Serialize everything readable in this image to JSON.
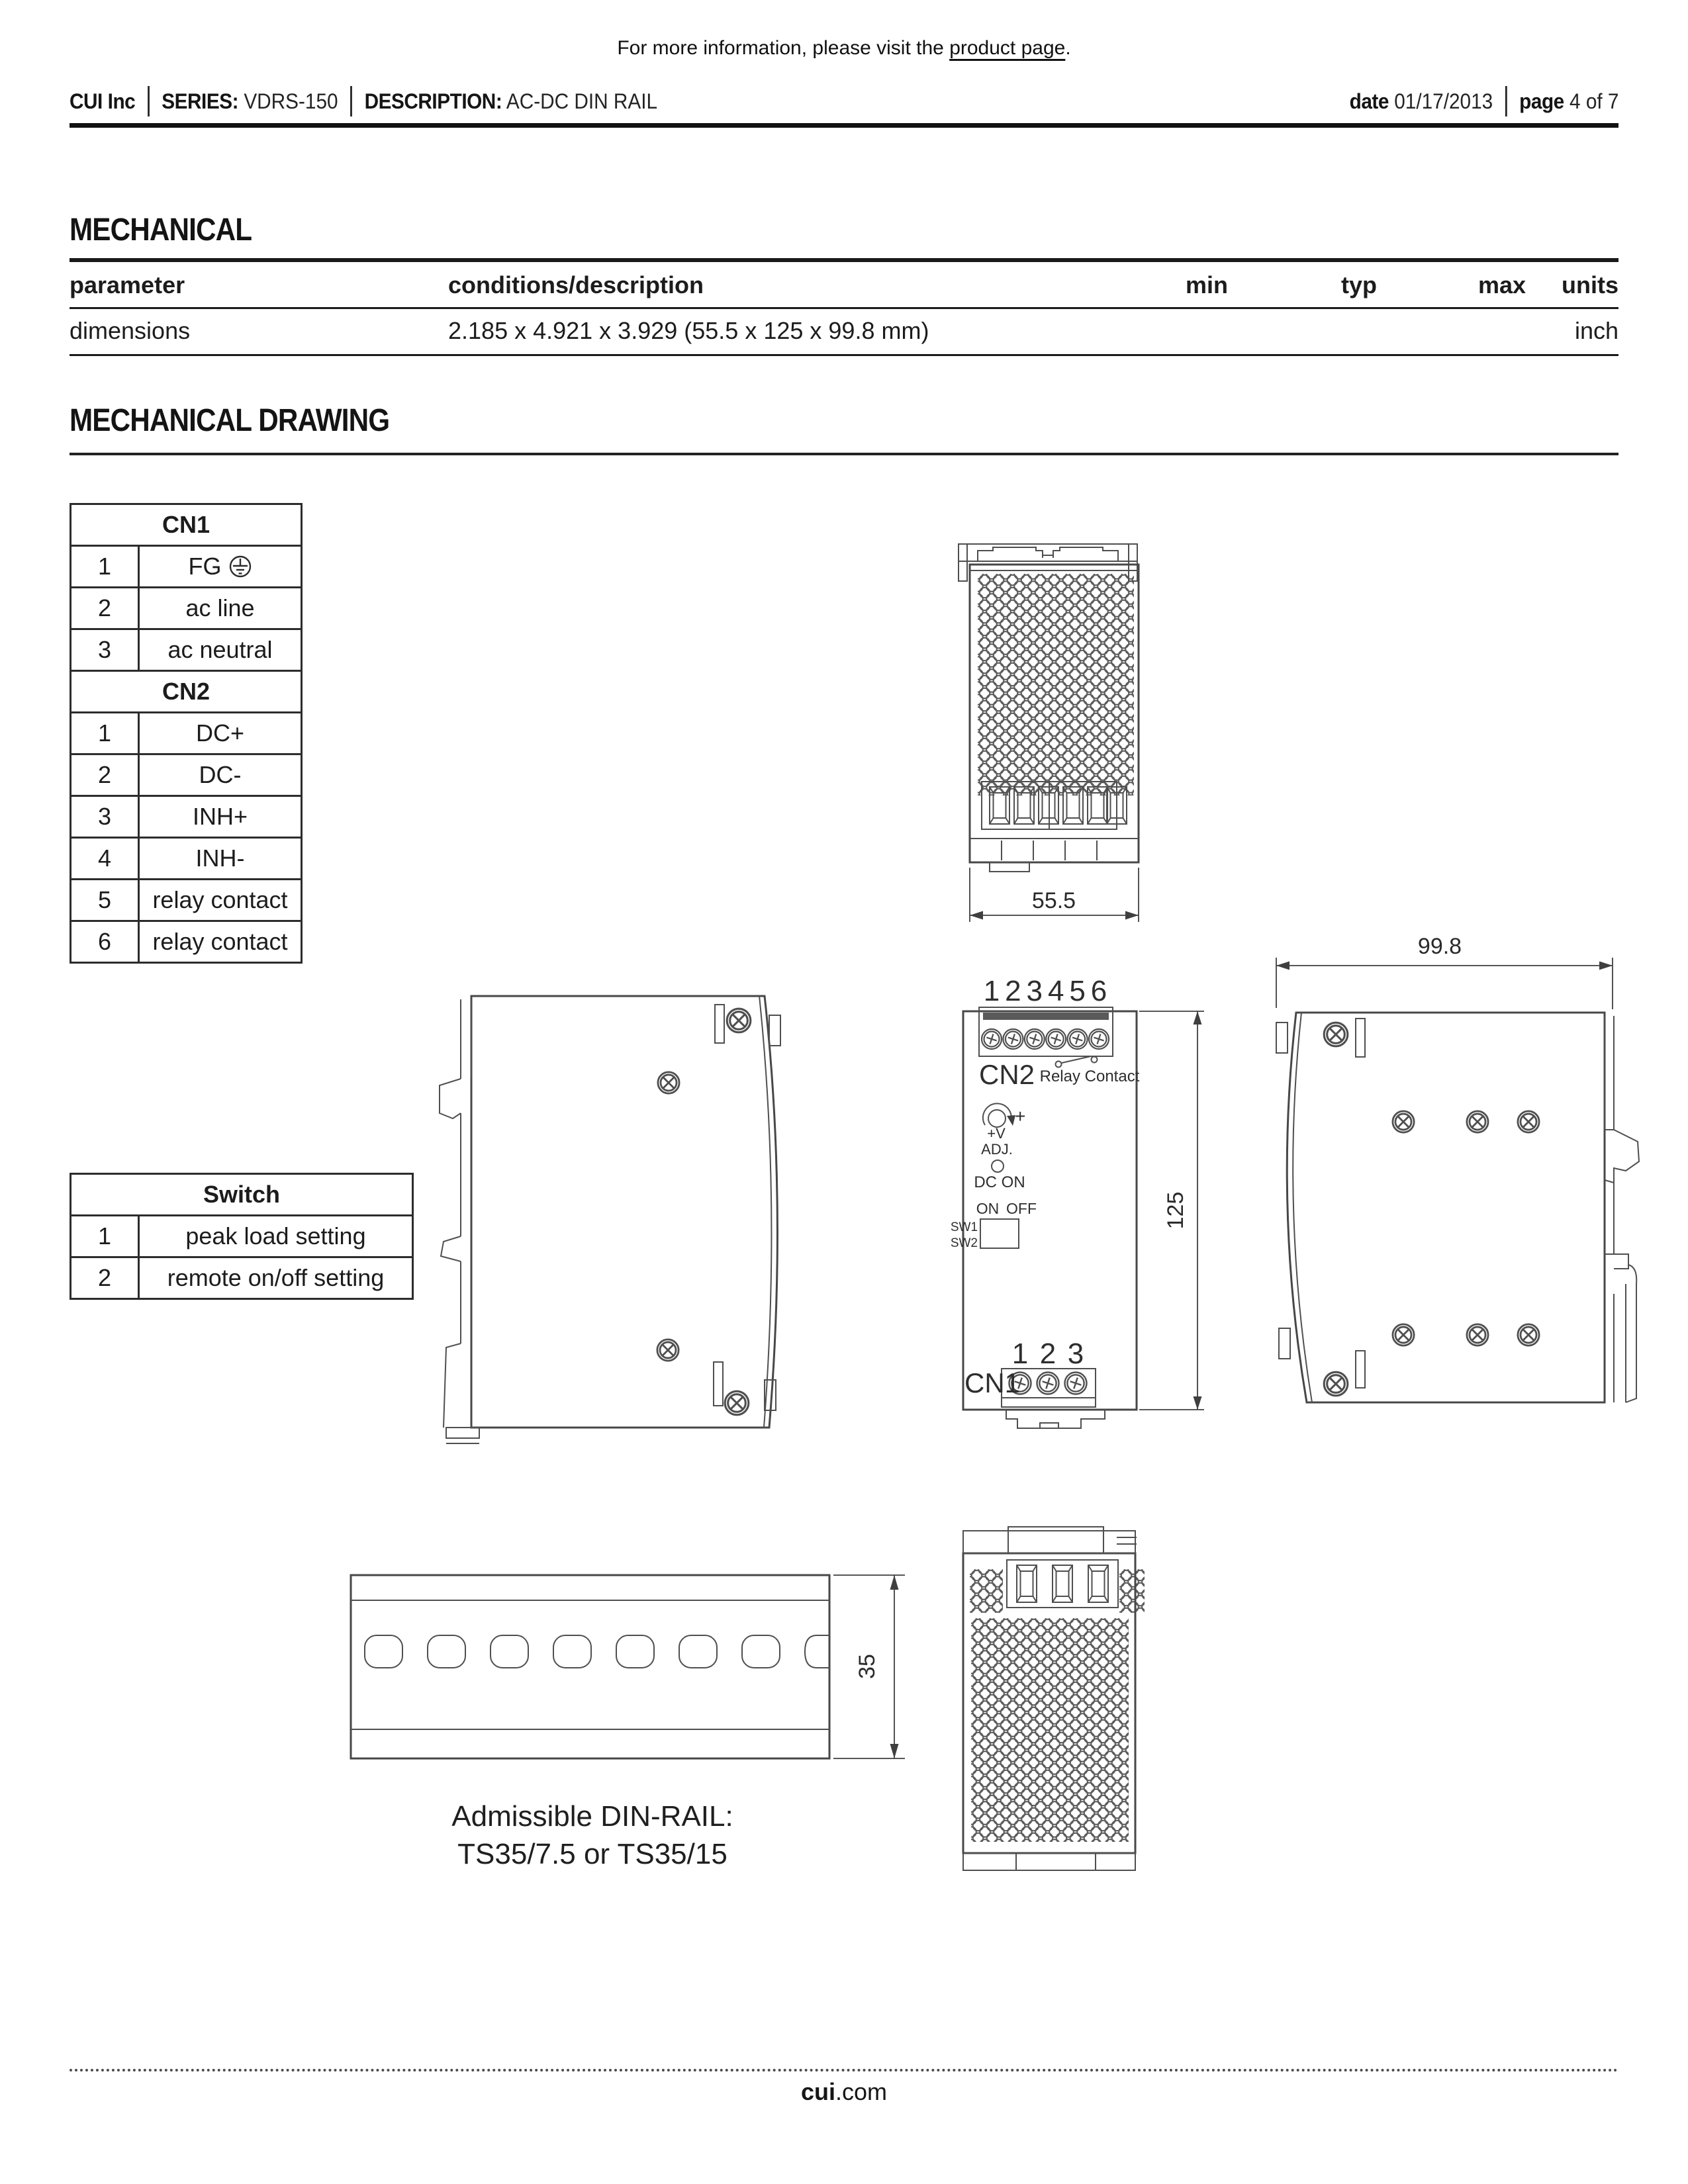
{
  "header": {
    "note_prefix": "For more information, please visit the ",
    "note_link": "product page",
    "note_suffix": ".",
    "company": "CUI Inc",
    "series_label": "SERIES:",
    "series_value": "VDRS-150",
    "description_label": "DESCRIPTION:",
    "description_value": "AC-DC DIN RAIL",
    "date_label": "date",
    "date_value": "01/17/2013",
    "page_label": "page",
    "page_value": "4 of 7"
  },
  "mechanical": {
    "title": "MECHANICAL",
    "table": {
      "headers": [
        "parameter",
        "conditions/description",
        "min",
        "typ",
        "max",
        "units"
      ],
      "rows": [
        {
          "parameter": "dimensions",
          "conditions": "2.185 x 4.921 x 3.929 (55.5 x 125 x 99.8 mm)",
          "min": "",
          "typ": "",
          "max": "",
          "units": "inch"
        }
      ]
    }
  },
  "drawing": {
    "title": "MECHANICAL DRAWING",
    "cn1": {
      "title": "CN1",
      "rows": [
        {
          "num": "1",
          "label": "FG"
        },
        {
          "num": "2",
          "label": "ac line"
        },
        {
          "num": "3",
          "label": "ac neutral"
        }
      ]
    },
    "cn2": {
      "title": "CN2",
      "rows": [
        {
          "num": "1",
          "label": "DC+"
        },
        {
          "num": "2",
          "label": "DC-"
        },
        {
          "num": "3",
          "label": "INH+"
        },
        {
          "num": "4",
          "label": "INH-"
        },
        {
          "num": "5",
          "label": "relay contact"
        },
        {
          "num": "6",
          "label": "relay contact"
        }
      ]
    },
    "switch": {
      "title": "Switch",
      "rows": [
        {
          "num": "1",
          "label": "peak load setting"
        },
        {
          "num": "2",
          "label": "remote on/off setting"
        }
      ]
    },
    "top_view": {
      "dim_width": "55.5"
    },
    "front_view": {
      "pins_top": [
        "1",
        "2",
        "3",
        "4",
        "5",
        "6"
      ],
      "cn2_label": "CN2",
      "relay_label": "Relay Contact",
      "plus": "+",
      "adj_line1": "+V",
      "adj_line2": "ADJ.",
      "dc_on": "DC ON",
      "on": "ON",
      "off": "OFF",
      "sw1": "SW1",
      "sw2": "SW2",
      "pins_bottom": [
        "1",
        "2",
        "3"
      ],
      "cn1_label": "CN1",
      "dim_height": "125"
    },
    "side_view": {
      "dim_depth": "99.8"
    },
    "din_rail": {
      "dim_height": "35",
      "caption_line1": "Admissible DIN-RAIL:",
      "caption_line2": "TS35/7.5 or TS35/15"
    }
  },
  "footer": {
    "site_bold": "cui",
    "site_rest": ".com"
  }
}
